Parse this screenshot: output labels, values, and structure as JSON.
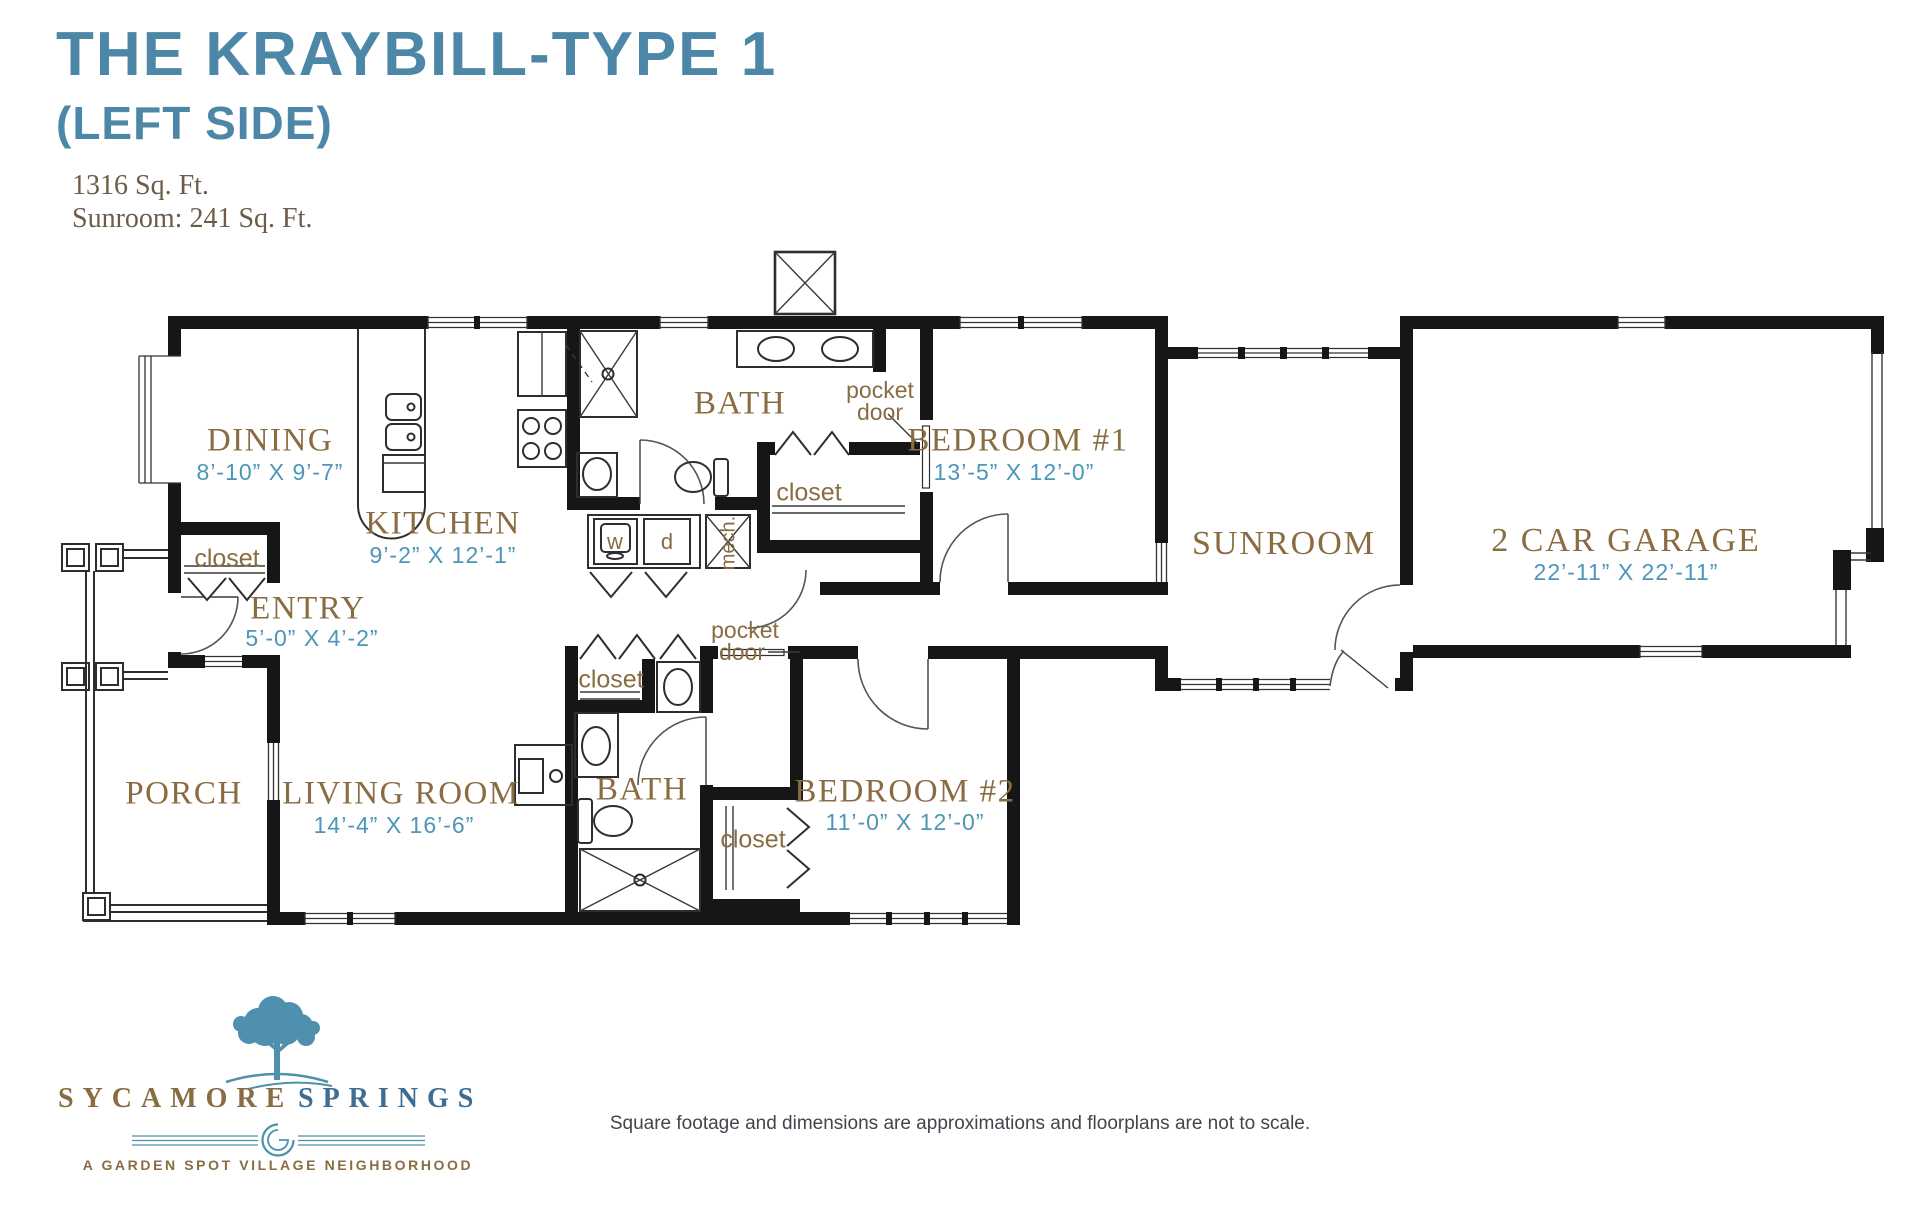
{
  "header": {
    "title": "THE KRAYBILL-TYPE 1",
    "subtitle": "(LEFT SIDE)",
    "sqft": "1316 Sq. Ft.",
    "sunroom_sqft": "Sunroom: 241 Sq. Ft."
  },
  "rooms": {
    "dining": {
      "name": "DINING",
      "dims": "8’-10” X 9’-7”"
    },
    "kitchen": {
      "name": "KITCHEN",
      "dims": "9’-2” X 12’-1”"
    },
    "bath1": {
      "name": "BATH"
    },
    "bedroom1": {
      "name": "BEDROOM #1",
      "dims": "13’-5” X 12’-0”"
    },
    "sunroom": {
      "name": "SUNROOM"
    },
    "garage": {
      "name": "2 CAR GARAGE",
      "dims": "22’-11” X 22’-11”"
    },
    "entry": {
      "name": "ENTRY",
      "dims": "5’-0” X 4’-2”"
    },
    "porch": {
      "name": "PORCH"
    },
    "living": {
      "name": "LIVING ROOM",
      "dims": "14’-4” X 16’-6”"
    },
    "bath2": {
      "name": "BATH"
    },
    "bedroom2": {
      "name": "BEDROOM #2",
      "dims": "11’-0” X 12’-0”"
    }
  },
  "annotations": {
    "closet": "closet",
    "pocket": "pocket",
    "door": "door",
    "washer": "w",
    "dryer": "d",
    "mech": "mech."
  },
  "logo": {
    "name_left": "SYCAMORE",
    "name_right": "SPRINGS",
    "tagline": "A GARDEN SPOT VILLAGE NEIGHBORHOOD"
  },
  "footer": {
    "disclaimer": "Square footage and dimensions are approximations and floorplans are not to scale."
  },
  "colors": {
    "title_blue": "#4d87a7",
    "label_brown": "#8a6c42",
    "dimension_blue": "#4d96b8",
    "logo_blue": "#4e90ad",
    "logo_navy": "#3d6d92",
    "sqft_brown": "#6d5c48",
    "wall_black": "#161616",
    "footer_gray": "#41464d"
  }
}
